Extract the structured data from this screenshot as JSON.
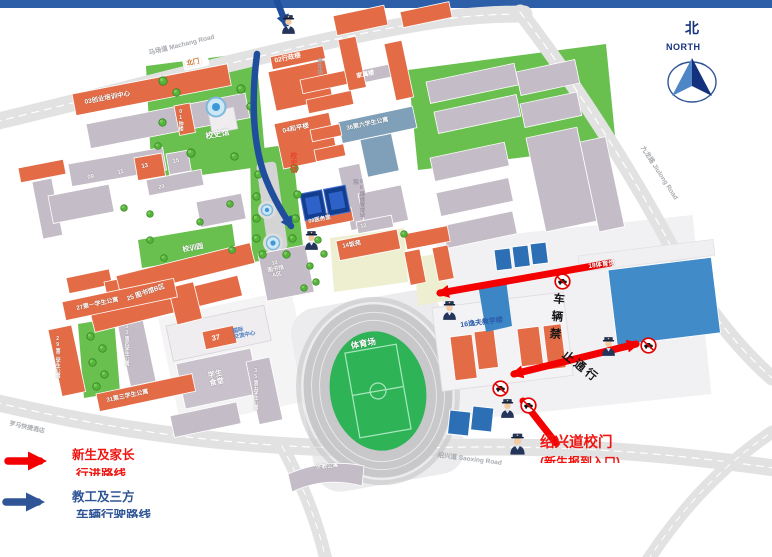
{
  "colors": {
    "topbar": "#2D5FA8",
    "route_red": "#F40000",
    "route_blue": "#1F4E9C",
    "legend_red_text": "#F01410",
    "legend_blue_text": "#2F5597"
  },
  "compass": {
    "zh": "北",
    "en": "NORTH"
  },
  "roads": {
    "machang": "马场道 Machang Road",
    "jiulong": "九龙路 Jiulong Road",
    "shaoxing": "绍兴道 Saoxing Road",
    "hotel": "罗马快捷酒店",
    "north_gate": "北门"
  },
  "buildings": {
    "b01": "01钟楼",
    "b02": "02行政楼",
    "b03": "03创业培训中心",
    "b04": "04和平楼",
    "b06": "06继续教育学院",
    "b08": "08医务室",
    "b09": "09",
    "b10": "10\n图书馆\nA区",
    "b11": "11",
    "b12": "12",
    "b13": "13",
    "b14": "14饭苑",
    "b15": "15",
    "b16": "16逸夫教学楼",
    "b18": "18体育馆",
    "b23": "23",
    "b25": "25 图书馆B区",
    "b27": "27第一学生公寓",
    "b29": "29第二学生公寓",
    "b31": "31第三学生公寓",
    "b33": "33第四学生公寓",
    "b35": "35第五学生公寓",
    "b36": "36第六学生公寓",
    "b37": "37",
    "intl_center": "国际\n交流中心",
    "canteen": "学生\n食堂",
    "family": "家属楼",
    "parking": "停车场",
    "history_hall": "校史馆",
    "history_hall_side": "校史馆",
    "motto_garden": "校训园",
    "stadium": "体育场",
    "foreign_apt": "外教公寓"
  },
  "annotations": {
    "no_vehicles_top": "车辆禁",
    "no_vehicles_bottom": "止通行",
    "gate_title": "绍兴道校门",
    "gate_subtitle": "(新生报到入口)"
  },
  "legend": {
    "freshmen_line1": "新生及家长",
    "freshmen_line2": "行进路线",
    "staff_line1": "教工及三方",
    "staff_line2": "车辆行驶路线"
  }
}
